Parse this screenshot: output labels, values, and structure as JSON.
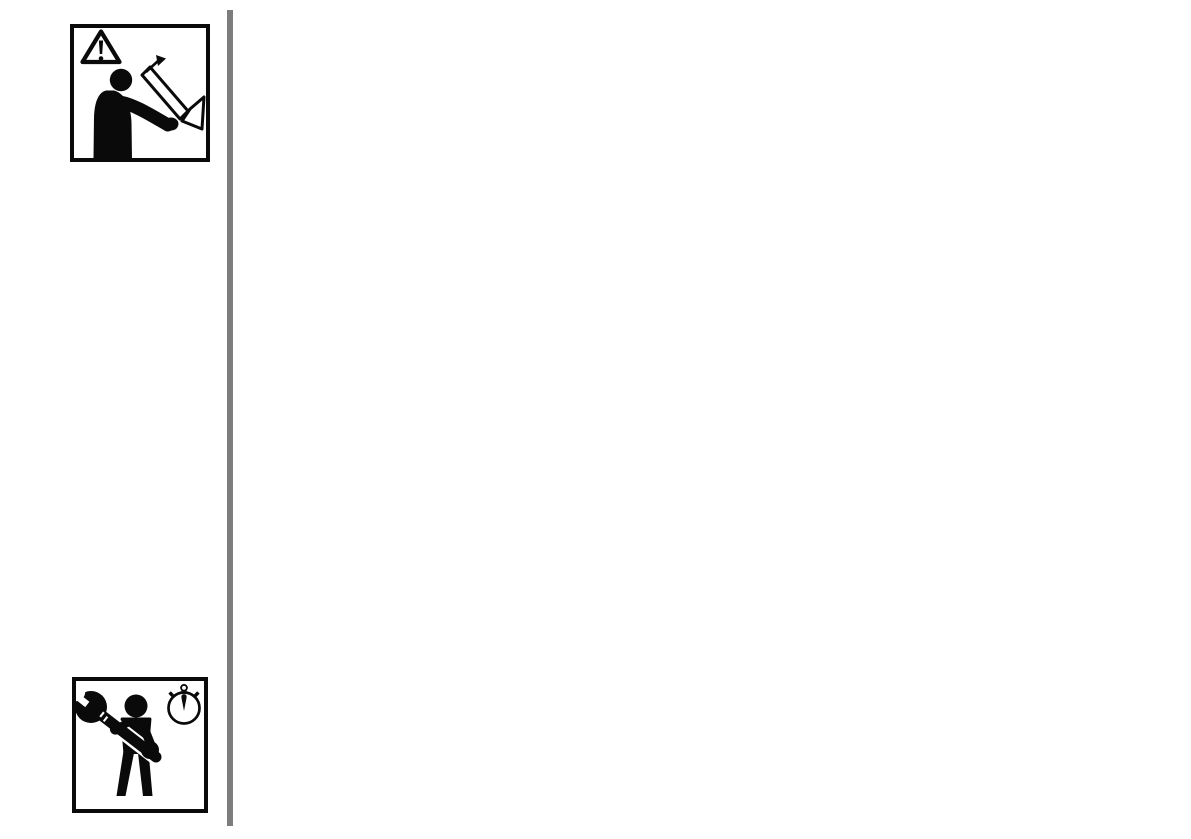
{
  "colors": {
    "ink": "#0a0a0a",
    "paper": "#ffffff",
    "rule": "#7d7d7d"
  },
  "pictograms": {
    "read_manual": {
      "aria_label": "read-operating-manual-pictogram",
      "icons": [
        "warning-triangle-icon",
        "person-reading-manual-icon"
      ]
    },
    "service": {
      "aria_label": "person-with-wrench-and-stopwatch-pictogram",
      "icons": [
        "person-with-wrench-icon",
        "stopwatch-icon"
      ]
    },
    "divider": {
      "aria_label": "vertical-margin-rule"
    }
  }
}
